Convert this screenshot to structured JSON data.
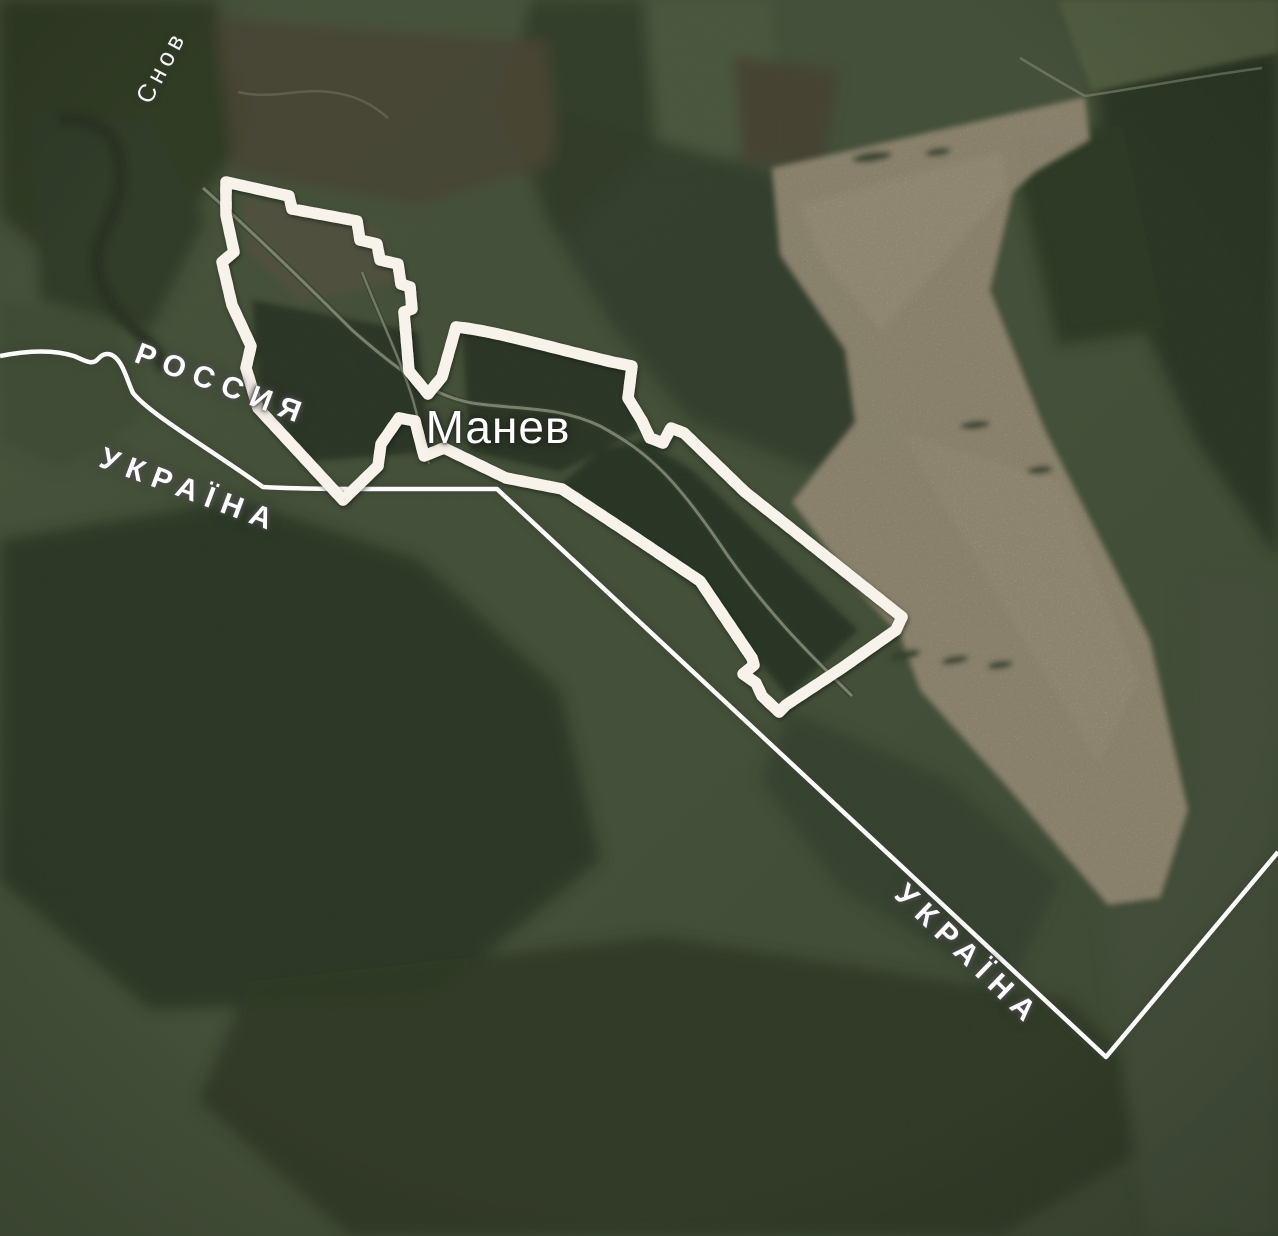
{
  "map": {
    "labels": {
      "river": {
        "text": "Снов"
      },
      "russia": {
        "text": "РОССИЯ"
      },
      "ukraine_west": {
        "text": "УКРАЇНА"
      },
      "ukraine_south": {
        "text": "УКРАЇНА"
      },
      "settlement": {
        "text": "Манев"
      }
    },
    "colors": {
      "stripe_red": "#c03a28",
      "stripe_white": "#f7f2ea",
      "border_line": "#fbfbf9",
      "border_halo": "#3c4036",
      "field_tan": "#b3a08a",
      "label_text": "#ffffff"
    }
  }
}
